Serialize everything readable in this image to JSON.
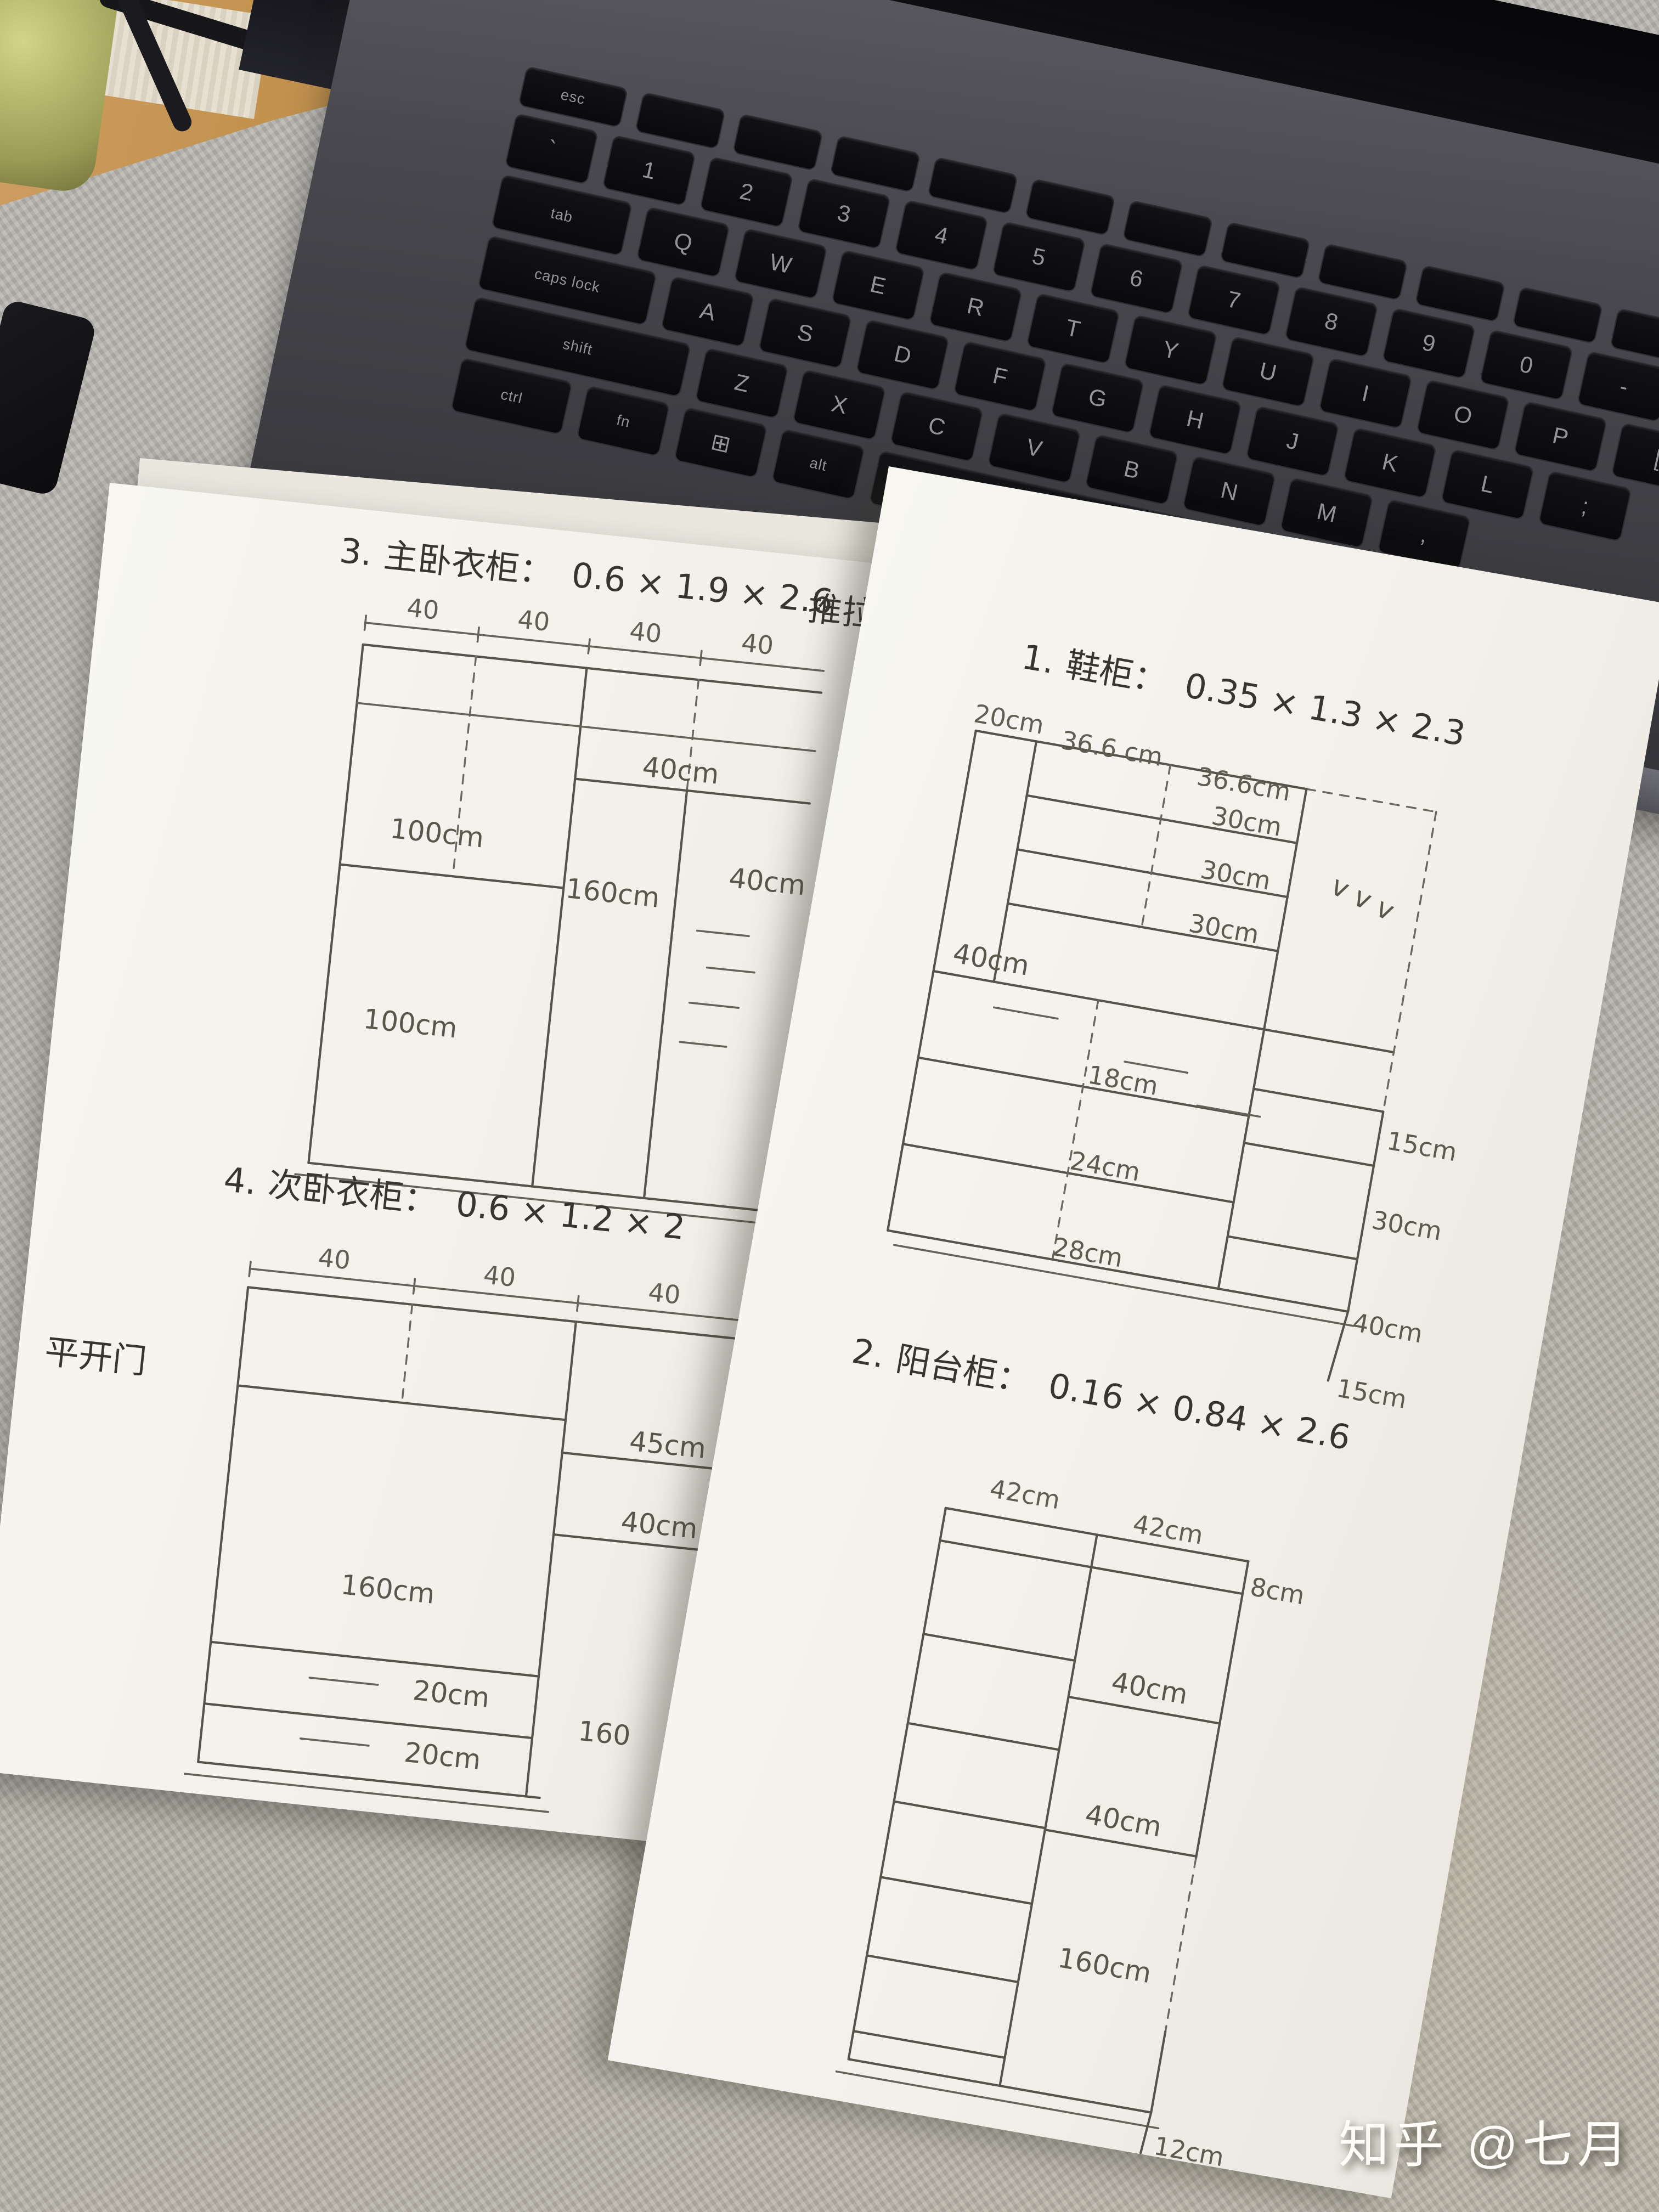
{
  "watermark": {
    "text": "知乎 @七月"
  },
  "keyboard": {
    "rows": [
      {
        "h": 70,
        "keys": [
          [
            "esc",
            1.2
          ],
          [
            "",
            1
          ],
          [
            "",
            1
          ],
          [
            "",
            1
          ],
          [
            "",
            1
          ],
          [
            "",
            1
          ],
          [
            "",
            1
          ],
          [
            "",
            1
          ],
          [
            "",
            1
          ],
          [
            "",
            1
          ],
          [
            "",
            1
          ],
          [
            "",
            1
          ]
        ]
      },
      {
        "h": 96,
        "keys": [
          [
            "`",
            1
          ],
          [
            "1",
            1
          ],
          [
            "2",
            1
          ],
          [
            "3",
            1
          ],
          [
            "4",
            1
          ],
          [
            "5",
            1
          ],
          [
            "6",
            1
          ],
          [
            "7",
            1
          ],
          [
            "8",
            1
          ],
          [
            "9",
            1
          ],
          [
            "0",
            1
          ],
          [
            "-",
            1
          ],
          [
            "=",
            1
          ]
        ]
      },
      {
        "h": 96,
        "keys": [
          [
            "tab",
            1.5
          ],
          [
            "Q",
            1
          ],
          [
            "W",
            1
          ],
          [
            "E",
            1
          ],
          [
            "R",
            1
          ],
          [
            "T",
            1
          ],
          [
            "Y",
            1
          ],
          [
            "U",
            1
          ],
          [
            "I",
            1
          ],
          [
            "O",
            1
          ],
          [
            "P",
            1
          ],
          [
            "[",
            1
          ]
        ]
      },
      {
        "h": 96,
        "keys": [
          [
            "caps lock",
            1.9
          ],
          [
            "A",
            1
          ],
          [
            "S",
            1
          ],
          [
            "D",
            1
          ],
          [
            "F",
            1
          ],
          [
            "G",
            1
          ],
          [
            "H",
            1
          ],
          [
            "J",
            1
          ],
          [
            "K",
            1
          ],
          [
            "L",
            1
          ],
          [
            ";",
            1
          ]
        ]
      },
      {
        "h": 96,
        "keys": [
          [
            "shift",
            2.4
          ],
          [
            "Z",
            1
          ],
          [
            "X",
            1
          ],
          [
            "C",
            1
          ],
          [
            "V",
            1
          ],
          [
            "B",
            1
          ],
          [
            "N",
            1
          ],
          [
            "M",
            1
          ],
          [
            ",",
            1
          ]
        ]
      },
      {
        "h": 96,
        "keys": [
          [
            "ctrl",
            1.3
          ],
          [
            "fn",
            1
          ],
          [
            "⊞",
            1
          ],
          [
            "alt",
            1
          ],
          [
            "",
            4.6
          ],
          [
            "alt",
            1
          ]
        ]
      }
    ]
  },
  "paper_left": {
    "cabinet3": {
      "title_index": "3.",
      "title_name": "主卧衣柜：",
      "title_dims": "0.6 × 1.9 × 2.6",
      "title_note": "推拉",
      "col_widths": [
        "40",
        "40",
        "40",
        "40"
      ],
      "shelf_top": "40cm",
      "shelf_upper": "100cm",
      "shelf_lower": "100cm",
      "hanging": "160cm",
      "right_shelf": "40cm"
    },
    "cabinet4": {
      "title_index": "4.",
      "title_name": "次卧衣柜：",
      "title_dims": "0.6 × 1.2 × 2",
      "door_note": "平开门",
      "col_widths": [
        "40",
        "40",
        "40"
      ],
      "top_shelf": "45cm",
      "mid_shelf": "40cm",
      "hanging": "160cm",
      "right_hanging": "160",
      "drawer1": "20cm",
      "drawer2": "20cm"
    }
  },
  "paper_right": {
    "cabinet1": {
      "title_index": "1.",
      "title_name": "鞋柜：",
      "title_dims": "0.35 × 1.3 × 2.3",
      "col_widths": [
        "20cm",
        "36.6 cm",
        "36.6cm"
      ],
      "shelf_rows": [
        "30cm",
        "30cm",
        "30cm"
      ],
      "mid_section": "40cm",
      "drawers": [
        "18cm",
        "24cm",
        "28cm"
      ],
      "side_heights": [
        "15cm",
        "30cm",
        "40cm",
        "15cm"
      ],
      "vent_marks": "v  v  v"
    },
    "cabinet2": {
      "title_index": "2.",
      "title_name": "阳台柜：",
      "title_dims": "0.16 × 0.84 × 2.6",
      "col_widths": [
        "42cm",
        "42cm"
      ],
      "top_strip": "8cm",
      "shelf1": "40cm",
      "shelf2": "40cm",
      "tall_section": "160cm",
      "bottom_strip": "12cm"
    }
  }
}
